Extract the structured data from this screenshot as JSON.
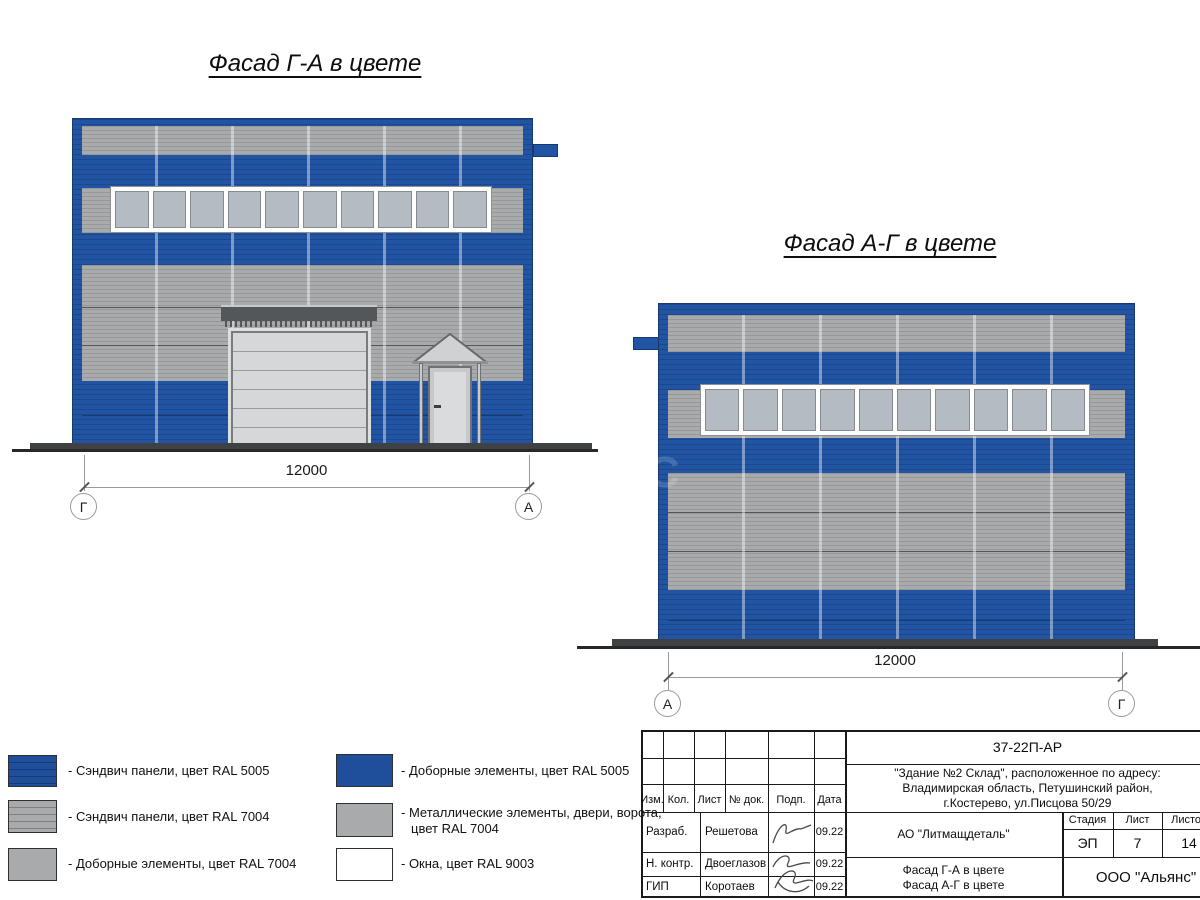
{
  "titles": {
    "facade_left": "Фасад Г-А в цвете",
    "facade_right": "Фасад А-Г в цвете"
  },
  "facade_left": {
    "dimension": "12000",
    "axis_left": "Г",
    "axis_right": "А"
  },
  "facade_right": {
    "dimension": "12000",
    "axis_left": "А",
    "axis_right": "Г"
  },
  "watermark": {
    "text": "С"
  },
  "colors": {
    "ral5005": "#1f4e9b",
    "ral7004": "#a8aaab",
    "ral9003": "#ffffff",
    "glass": "#b5bbc3",
    "facade_blue": "#2154a3"
  },
  "legend": {
    "items": [
      {
        "label": "- Сэндвич панели, цвет RAL 5005",
        "color_key": "ral5005"
      },
      {
        "label": "- Сэндвич панели, цвет RAL 7004",
        "color_key": "ral7004"
      },
      {
        "label": "- Доборные элементы, цвет RAL 7004",
        "color_key": "ral7004"
      },
      {
        "label": "- Доборные элементы, цвет RAL 5005",
        "color_key": "ral5005"
      },
      {
        "label": "- Металлические элементы, двери, ворота,",
        "label2": "цвет RAL 7004",
        "color_key": "ral7004"
      },
      {
        "label": "- Окна, цвет RAL 9003",
        "color_key": "ral9003"
      }
    ]
  },
  "title_block": {
    "doc_code": "37-22П-АР",
    "object_address_lines": [
      "\"Здание №2 Склад\", расположенное по адресу:",
      "Владимирская область, Петушинский район,",
      "г.Костерево, ул.Писцова 50/29"
    ],
    "columns": [
      "Изм.",
      "Кол.",
      "Лист",
      "№ док.",
      "Подп.",
      "Дата"
    ],
    "staff": [
      {
        "role": "Разраб.",
        "name": "Решетова",
        "date": "09.22"
      },
      {
        "role": "Н. контр.",
        "name": "Двоеглазов",
        "date": "09.22"
      },
      {
        "role": "ГИП",
        "name": "Коротаев",
        "date": "09.22"
      }
    ],
    "organization": "АО \"Литмащдеталь\"",
    "stage_headers": [
      "Стадия",
      "Лист",
      "Листов"
    ],
    "stage": "ЭП",
    "sheet": "7",
    "sheets": "14",
    "sheet_titles": [
      "Фасад Г-А в цвете",
      "Фасад А-Г в цвете"
    ],
    "company": "ООО \"Альянс\""
  }
}
